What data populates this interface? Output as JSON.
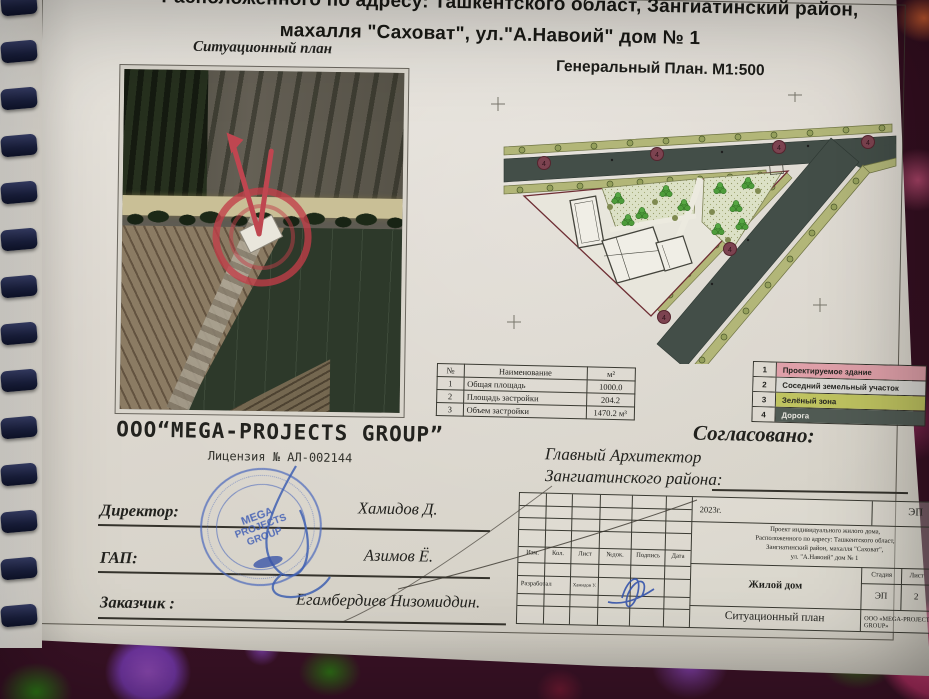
{
  "header": {
    "line1": "Расположенного по адресу: Ташкентского област, Зангиатинский район,",
    "line2": "махалля \"Саховат\",  ул.\"А.Навоий\"  дом № 1"
  },
  "captions": {
    "situational": "Ситуационный план",
    "general": "Генеральный  План. М1:500"
  },
  "area_table": {
    "col_num": "№",
    "col_name": "Наименование",
    "col_unit": "м²",
    "rows": [
      [
        "1",
        "Общая площадь",
        "1000.0"
      ],
      [
        "2",
        "Площадь застройки",
        "204.2"
      ],
      [
        "3",
        "Объем застройки",
        "1470.2 м³"
      ]
    ]
  },
  "legend": {
    "items": [
      {
        "num": "1",
        "label": "Проектируемое здание",
        "color": "#dfa0a9"
      },
      {
        "num": "2",
        "label": "Соседний земельный участок",
        "color": "#d8d7d2"
      },
      {
        "num": "3",
        "label": "Зелёный зона",
        "color": "#bfc360"
      },
      {
        "num": "4",
        "label": "Дорога",
        "color": "#515b54"
      }
    ]
  },
  "plan": {
    "marker_label": "4"
  },
  "company": {
    "name": "ООО“MEGA-PROJECTS GROUP”",
    "license": "Лицензия № АЛ-002144"
  },
  "approval": {
    "title": "Согласовано:",
    "line1": "Главный Архитектор",
    "line2": "Зангиатинского района:"
  },
  "signatures": [
    {
      "role": "Директор:",
      "name": "Хамидов Д."
    },
    {
      "role": "ГАП:",
      "name": "Азимов Ё."
    },
    {
      "role": "Заказчик :",
      "name": "Егамбердиев Низомиддин."
    }
  ],
  "stamp": {
    "line1": "MEGA",
    "line2": "PROJECTS",
    "line3": "GROUP"
  },
  "title_block": {
    "year": "2023г.",
    "code": "ЭП",
    "desc1": "Проект индивидуального жилого дома,",
    "desc2": "Расположенного по адресу: Ташкентского област,",
    "desc3": "Зангиатинский район, махалля \"Саховат\",",
    "desc4": "ул. \"А.Навоий\" дом № 1",
    "col_izm": "Изм.",
    "col_kol": "Кол.",
    "col_list": "Лист",
    "col_ndok": "№док.",
    "col_podpis": "Подпись",
    "col_data": "Дата",
    "razrabotal": "Разработал",
    "razrabotal_name": "Хамидов У.",
    "object_name": "Жилой дом",
    "stadia": "Стадия",
    "list": "Лист",
    "listov": "Листов",
    "stadia_val": "ЭП",
    "list_val": "2",
    "listov_val": "8",
    "sheet_name": "Ситуационный план",
    "org": "ООО «MEGA-PROJECTS GROUP»"
  }
}
